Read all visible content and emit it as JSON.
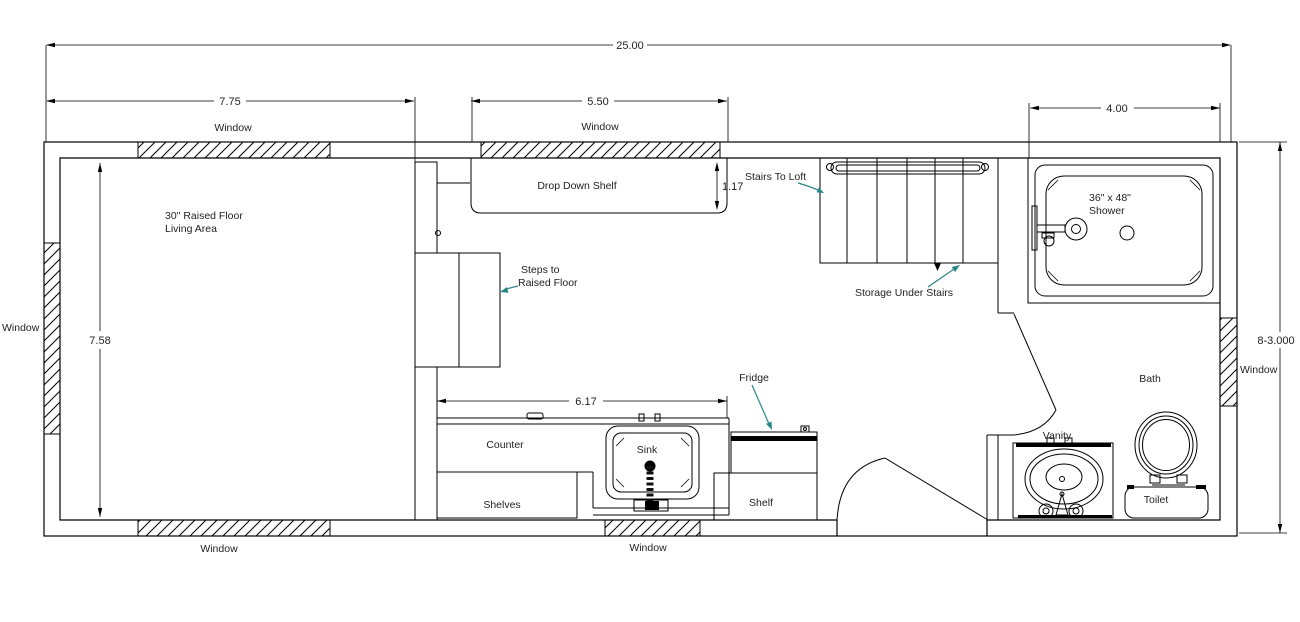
{
  "drawing": {
    "type": "floor-plan",
    "colors": {
      "line": "#000000",
      "text": "#1f1f1f",
      "leader_arrow": "#2a8585",
      "background": "#ffffff"
    },
    "dims": {
      "overall_width": "25.00",
      "left_window_width": "7.75",
      "mid_window_width": "5.50",
      "shower_width": "4.00",
      "living_area_depth": "7.58",
      "shelf_depth": "1.17",
      "counter_width": "6.17",
      "overall_depth": "8-3.000"
    },
    "labels": {
      "window": "Window",
      "living_line1": "30\" Raised Floor",
      "living_line2": "Living Area",
      "drop_down_shelf": "Drop Down Shelf",
      "stairs_to_loft": "Stairs To Loft",
      "storage_under_stairs": "Storage Under Stairs",
      "steps_line1": "Steps to",
      "steps_line2": "Raised Floor",
      "shower_line1": "36\" x 48\"",
      "shower_line2": "Shower",
      "fridge": "Fridge",
      "counter": "Counter",
      "sink": "Sink",
      "shelves": "Shelves",
      "shelf": "Shelf",
      "bath": "Bath",
      "vanity": "Vanity",
      "toilet": "Toilet"
    }
  }
}
